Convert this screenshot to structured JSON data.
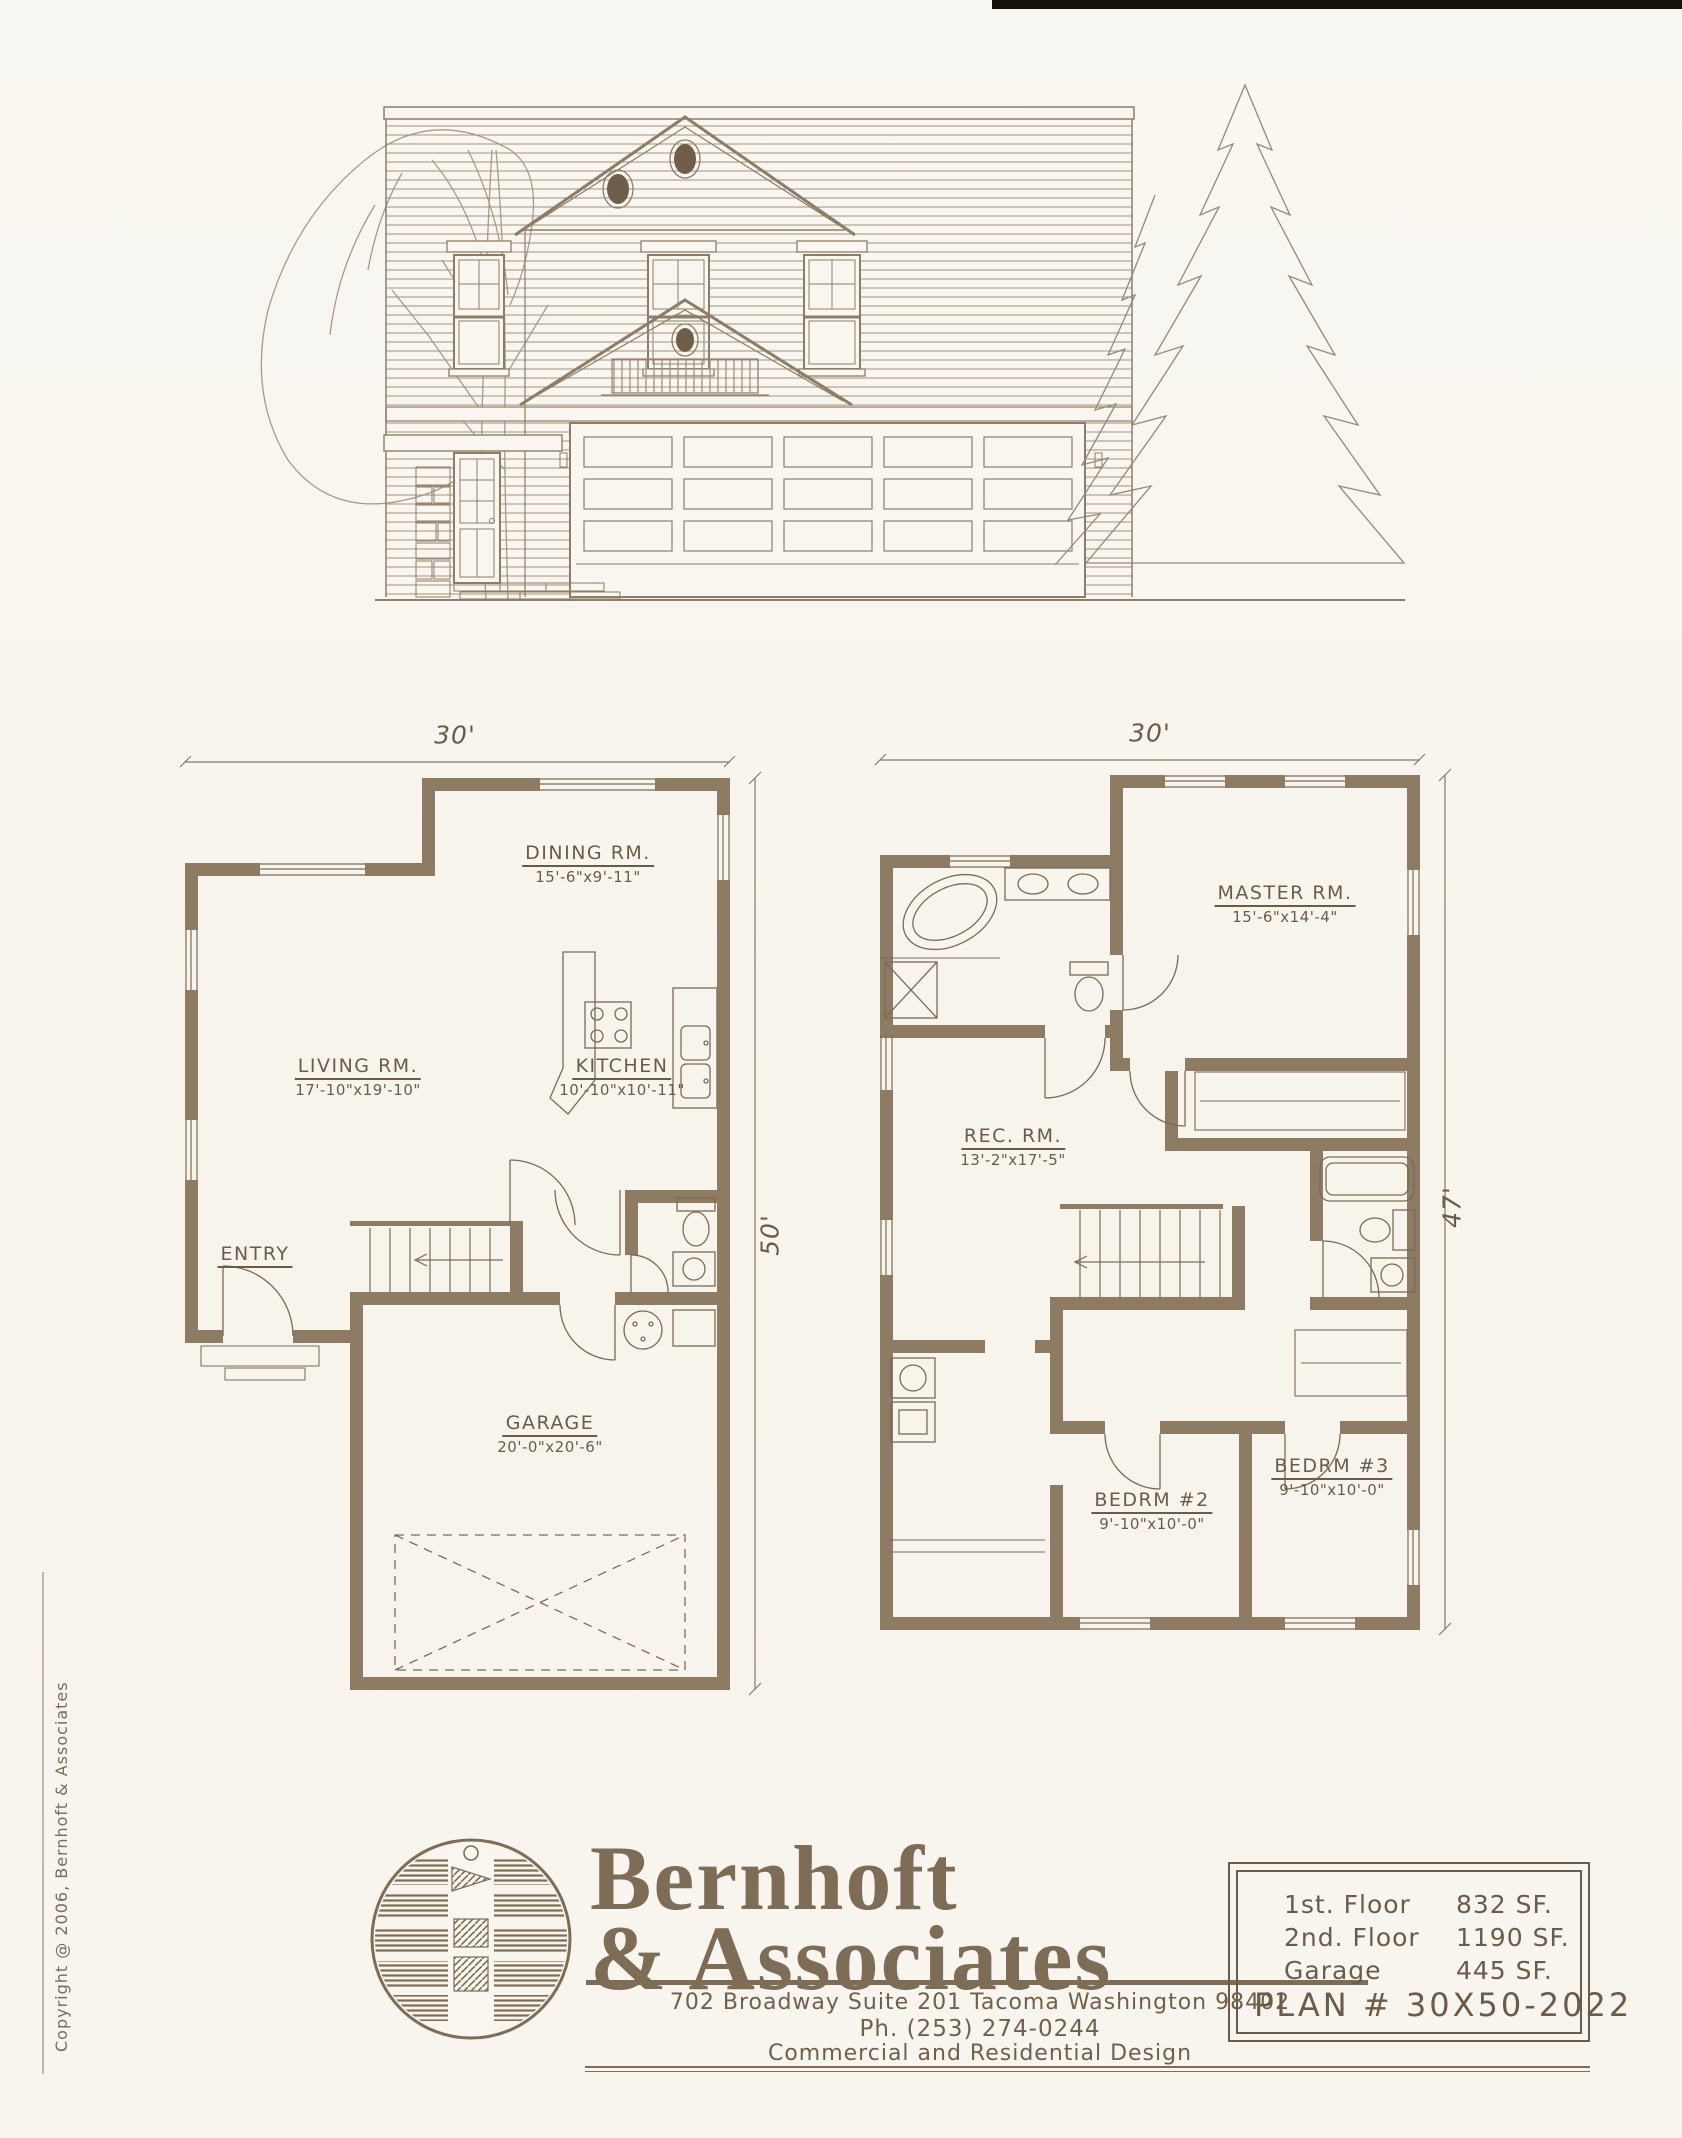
{
  "first_floor": {
    "width_label": "30'",
    "height_label": "50'",
    "rooms": {
      "dining": {
        "name": "DINING RM.",
        "size": "15'-6\"x9'-11\""
      },
      "living": {
        "name": "LIVING RM.",
        "size": "17'-10\"x19'-10\""
      },
      "kitchen": {
        "name": "KITCHEN",
        "size": "10'-10\"x10'-11\""
      },
      "entry": {
        "name": "ENTRY"
      },
      "garage": {
        "name": "GARAGE",
        "size": "20'-0\"x20'-6\""
      }
    }
  },
  "second_floor": {
    "width_label": "30'",
    "height_label": "47'",
    "rooms": {
      "master": {
        "name": "MASTER RM.",
        "size": "15'-6\"x14'-4\""
      },
      "rec": {
        "name": "REC. RM.",
        "size": "13'-2\"x17'-5\""
      },
      "bedrm2": {
        "name": "BEDRM #2",
        "size": "9'-10\"x10'-0\""
      },
      "bedrm3": {
        "name": "BEDRM #3",
        "size": "9'-10\"x10'-0\""
      }
    }
  },
  "title_block": {
    "company_line1": "Bernhoft",
    "company_line2": "& Associates",
    "address": "702 Broadway Suite 201 Tacoma Washington 98402",
    "phone": "Ph. (253) 274-0244",
    "tagline": "Commercial and Residential Design"
  },
  "plan_table": {
    "rows": [
      {
        "label": "1st. Floor",
        "value": "832 SF."
      },
      {
        "label": "2nd. Floor",
        "value": "1190 SF."
      },
      {
        "label": "Garage",
        "value": "445 SF."
      }
    ],
    "plan_number": "PLAN # 30X50-2022"
  },
  "sidebar": {
    "copyright": "Copyright @ 2006, Bernhoft & Associates"
  },
  "colors": {
    "wall": "#8d7b64",
    "line": "#7b6a54",
    "text": "#6b5b49",
    "accent": "#7d6c56",
    "paper": "#f8f6ef"
  }
}
